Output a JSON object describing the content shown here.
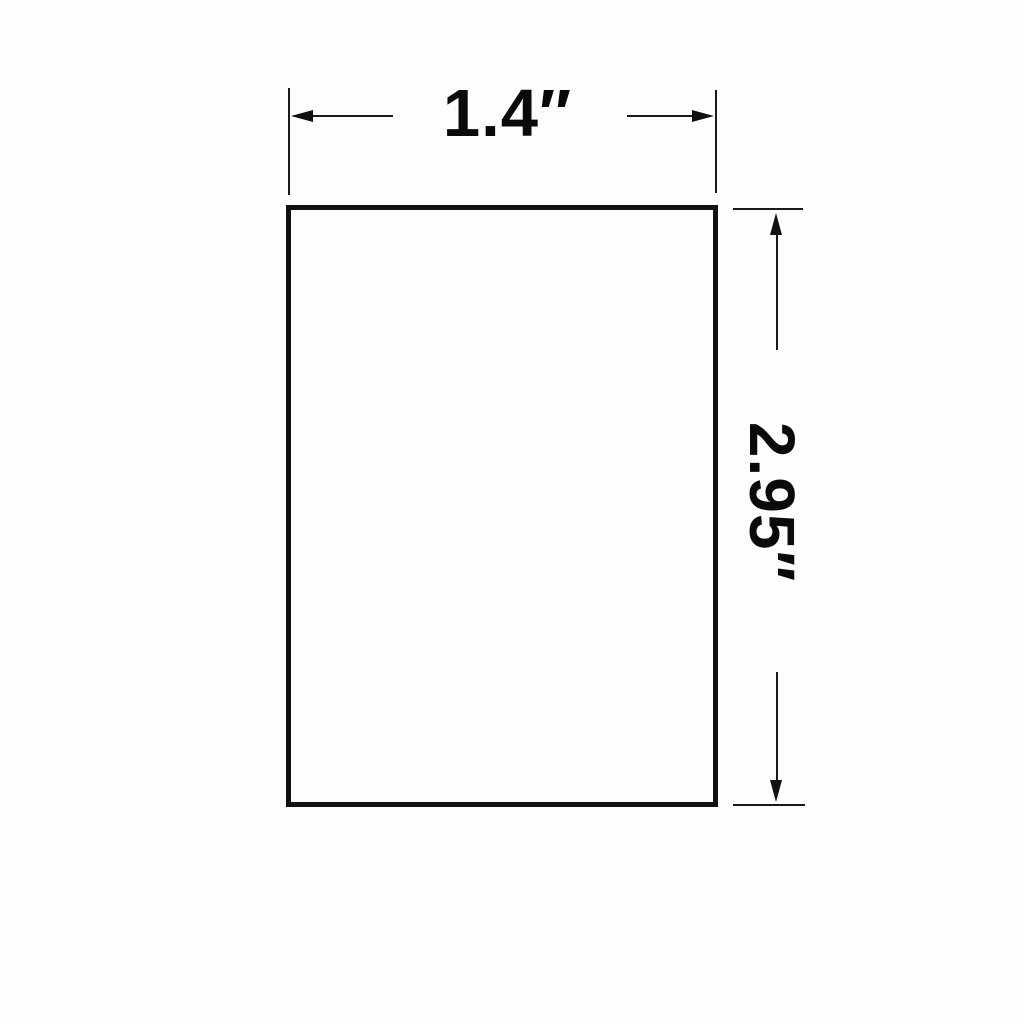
{
  "diagram": {
    "type": "dimensioned-rectangle-drawing",
    "width_label": "1.4″",
    "height_label": "2.95″",
    "colors": {
      "line": "#111111",
      "text": "#0a0a0a",
      "background": "#fdfdfd"
    }
  }
}
